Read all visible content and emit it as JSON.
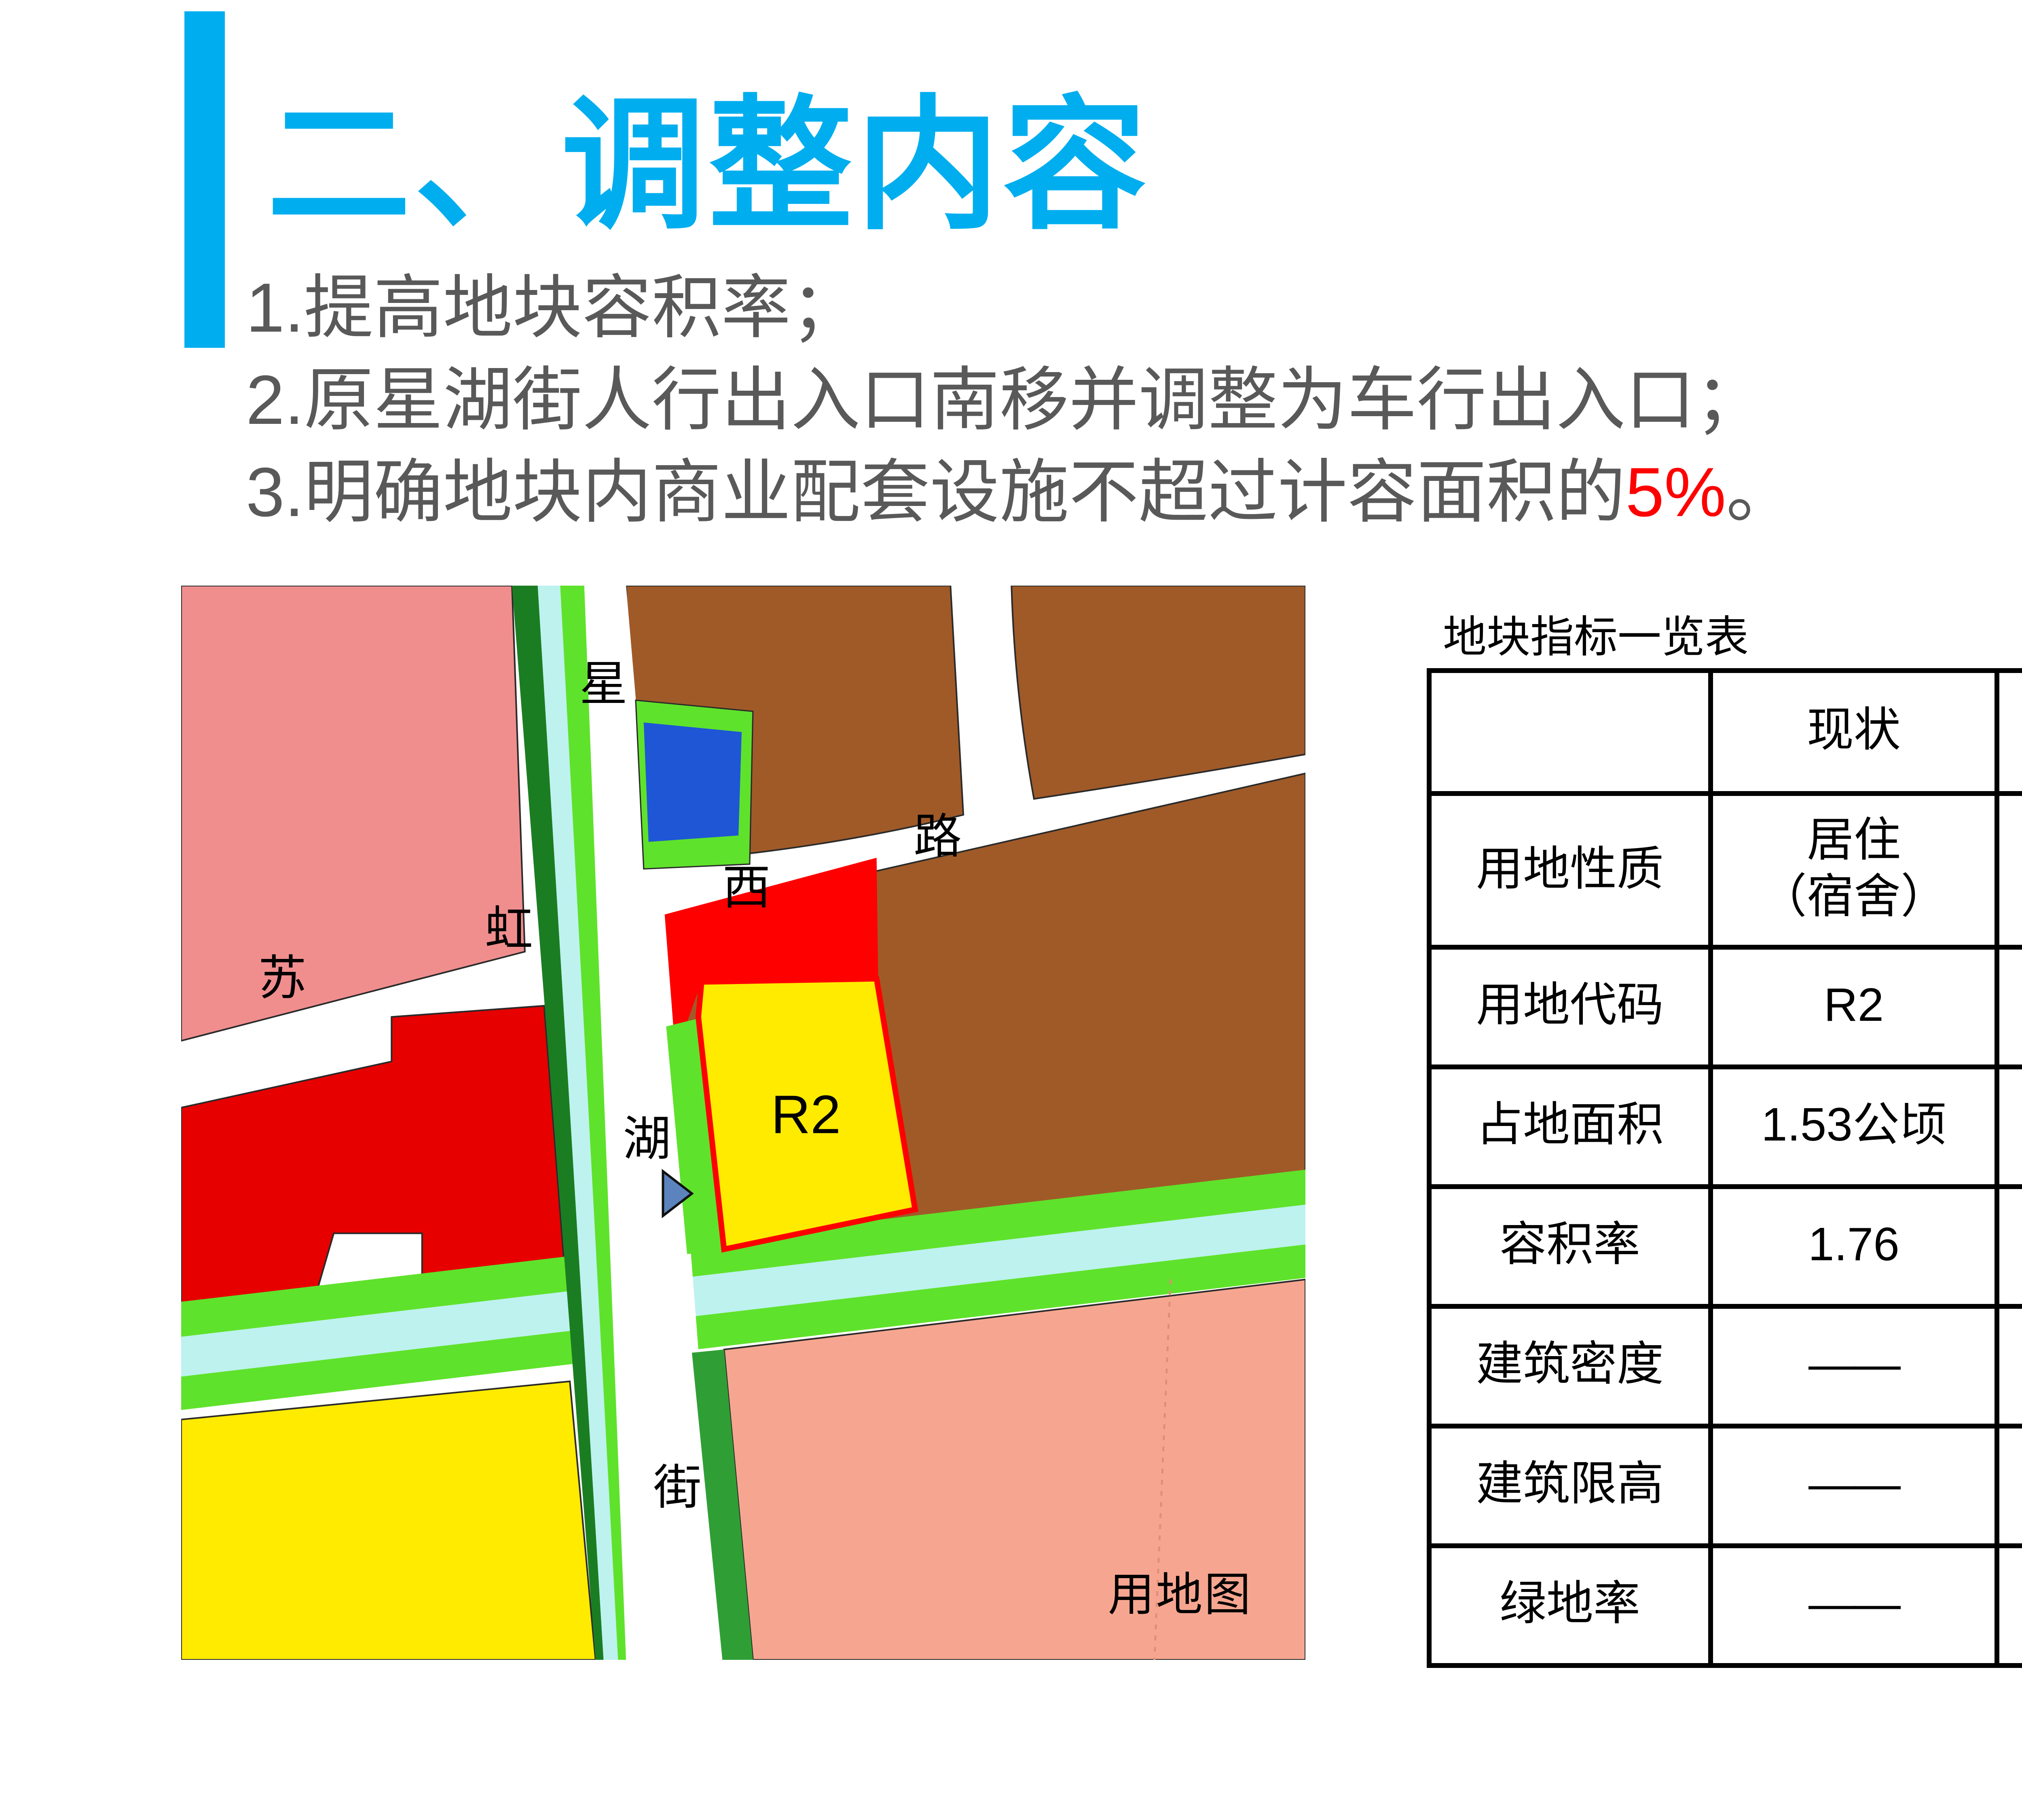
{
  "slide": {
    "title": "二、调整内容",
    "accent_color": "#00AEEF",
    "points": {
      "p1": "1.提高地块容积率；",
      "p2": "2.原星湖街人行出入口南移并调整为车行出入口；",
      "p3_prefix": "3.明确地块内商业配套设施不超过计容面积的",
      "p3_highlight": "5%",
      "p3_suffix": "。"
    },
    "highlight_color": "#FF0000"
  },
  "map": {
    "caption": "用地图",
    "parcel_label": "R2",
    "street_chars": {
      "xing": "星",
      "hu": "湖",
      "jie": "街",
      "su": "苏",
      "hong": "虹",
      "xi": "西",
      "lu": "路"
    },
    "colors": {
      "pink_parcel": "#F08E8E",
      "brown_parcel": "#A05A28",
      "red_parcel": "#E60000",
      "red_strip": "#FF0000",
      "plot_yellow": "#FFEB00",
      "plot_border_red": "#FF0000",
      "blue_parcel": "#1E56D6",
      "green_bright": "#5FE22B",
      "canal_cyan": "#BDF2EF",
      "green_dark": "#1B7D22",
      "green_medium": "#2F9F35",
      "salmon_parcel": "#F6A690",
      "marker_blue": "#5B84BE",
      "road_white": "#FFFFFF"
    }
  },
  "table": {
    "title": "地块指标一览表",
    "columns": [
      "",
      "现状",
      "调整后"
    ],
    "rows": [
      {
        "label": "用地性质",
        "current": "居住\n（宿舍）",
        "adjusted": "居住\n（宿舍）"
      },
      {
        "label": "用地代码",
        "current": "R2",
        "adjusted": "R2"
      },
      {
        "label": "占地面积",
        "current": "1.53公顷",
        "adjusted": "1.53公顷"
      },
      {
        "label": "容积率",
        "current": "1.76",
        "adjusted": "1.9"
      },
      {
        "label": "建筑密度",
        "current": "——",
        "adjusted": "——"
      },
      {
        "label": "建筑限高",
        "current": "——",
        "adjusted": "——"
      },
      {
        "label": "绿地率",
        "current": "——",
        "adjusted": "——"
      }
    ],
    "highlight_color": "#FF0000"
  }
}
